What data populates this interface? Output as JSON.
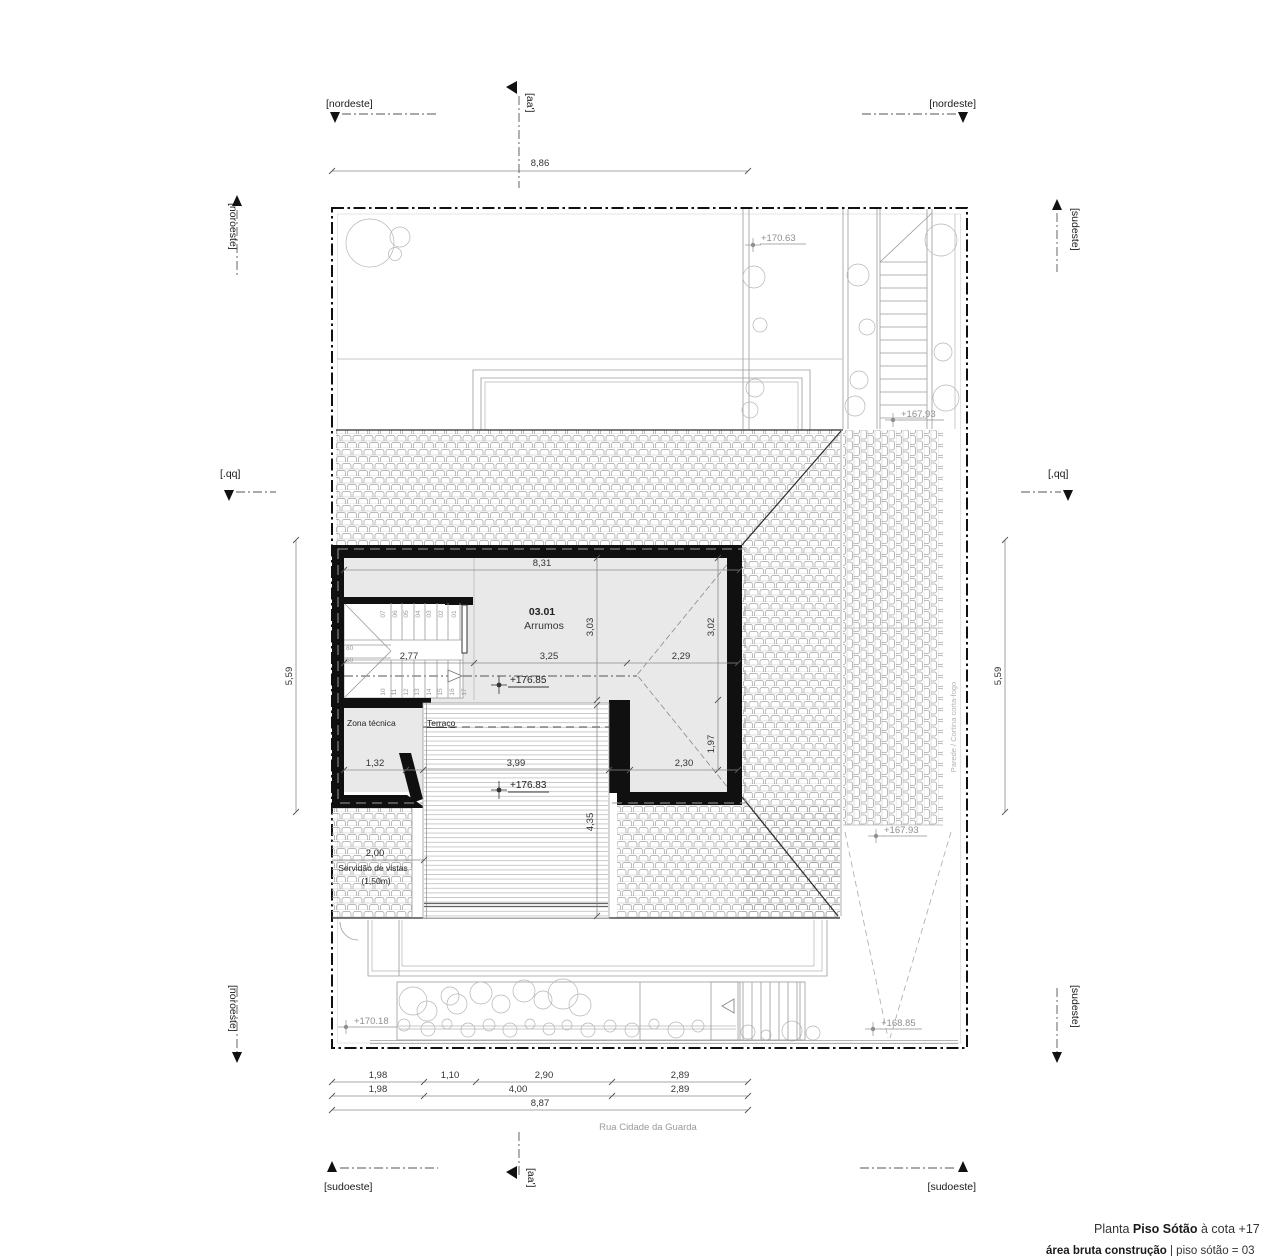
{
  "title_block": {
    "line1_prefix": "Planta ",
    "line1_bold": "Piso Sótão",
    "line1_suffix": " à cota +17",
    "line2_bold": "área bruta construção",
    "line2_suffix": " | piso sótão = 03"
  },
  "markers": {
    "nordeste_left": "[nordeste]",
    "nordeste_right": "[nordeste]",
    "aa_top": "[aa']",
    "aa_bottom": "[aa']",
    "noroeste_top": "[noroeste]",
    "noroeste_bottom": "[noroeste]",
    "sudeste_top": "[sudeste]",
    "sudeste_bottom": "[sudeste]",
    "qq_left": "[.qq]",
    "qq_right": "[,qq]",
    "sudoeste_left": "[sudoeste]",
    "sudoeste_right": "[sudoeste]"
  },
  "street": "Rua Cidade da Guarda",
  "plan": {
    "room_number": "03.01",
    "room_name": "Arrumos",
    "zona_tecnica": "Zona técnica",
    "terraco": "Terraço",
    "servidao1": "Servidão de vistas",
    "servidao2": "(1,50m)",
    "parede_note": "Parede / Cortina corta-fogo"
  },
  "levels": {
    "top_garden": "+170.63",
    "stair_top": "+167.93",
    "ramp_top": "+167.93",
    "room": "+176.85",
    "terrace": "+176.83",
    "ramp_bottom": "+168.85",
    "garden_bottom": "+170.18"
  },
  "dims": {
    "top": "8,86",
    "room_w": "8,31",
    "v303": "3,03",
    "v302": "3,02",
    "d277": "2,77",
    "d325": "3,25",
    "d229": "2,29",
    "d132": "1,32",
    "d399": "3,99",
    "d230": "2,30",
    "v197": "1,97",
    "v435": "4,35",
    "d200": "2,00",
    "side_left": "5,59",
    "side_right": "5,59",
    "b1": [
      "1,98",
      "1,10",
      "2,90",
      "2,89"
    ],
    "b2": [
      "1,98",
      "4,00",
      "2,89"
    ],
    "b3": "8,87"
  },
  "stairs": {
    "upper": [
      "07",
      "06",
      "05",
      "04",
      "03",
      "02",
      "01"
    ],
    "lower": [
      "10",
      "11",
      "12",
      "13",
      "14",
      "15",
      "16",
      "17"
    ],
    "w80": "80",
    "w60": "60"
  }
}
